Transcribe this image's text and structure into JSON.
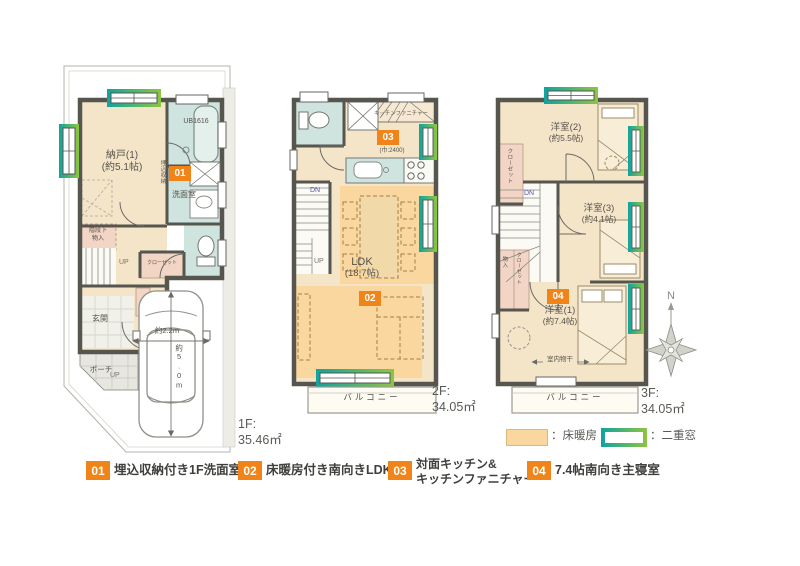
{
  "floor1": {
    "label": "1F:",
    "area": "35.46㎡",
    "badge": "01",
    "nando": "納戸(1)",
    "nando_size": "(約5.1帖)",
    "ub": "UB1616",
    "umekomi": "埋込収納",
    "senmen": "洗面室",
    "kaidanshita1": "階段下",
    "kaidanshita2": "物入",
    "closet": "クローゼット",
    "genkan": "玄関",
    "porch": "ポーチ",
    "up1": "UP",
    "up2": "UP",
    "car_w": "約2.2m",
    "car_d": "約5.0m"
  },
  "floor2": {
    "label": "2F:",
    "area": "34.05㎡",
    "badge_ldk": "02",
    "badge_kitchen": "03",
    "kitchen_furniture": "キッチンファニチャー",
    "kitchen_width": "(巾:2400)",
    "ldk": "LDK",
    "ldk_size": "(18.7帖)",
    "dn": "DN",
    "up": "UP",
    "balcony": "バルコニー"
  },
  "floor3": {
    "label": "3F:",
    "area": "34.05㎡",
    "badge": "04",
    "yoshitsu2": "洋室(2)",
    "yoshitsu2_size": "(約5.5帖)",
    "yoshitsu3": "洋室(3)",
    "yoshitsu3_size": "(約4.1帖)",
    "yoshitsu1": "洋室(1)",
    "yoshitsu1_size": "(約7.4帖)",
    "closet_upper": "クローゼット",
    "closet_lower": "クローゼット",
    "monoire": "物入",
    "dn": "DN",
    "drying": "室内物干",
    "balcony": "バルコニー"
  },
  "compass": {
    "north": "N"
  },
  "legend": {
    "heating": "：床暖房",
    "double_window": "：二重窓"
  },
  "notes": [
    {
      "num": "01",
      "line1": "埋込収納付き1F洗面室",
      "line2": ""
    },
    {
      "num": "02",
      "line1": "床暖房付き南向きLDK",
      "line2": ""
    },
    {
      "num": "03",
      "line1": "対面キッチン&",
      "line2": "キッチンファニチャー"
    },
    {
      "num": "04",
      "line1": "7.4帖南向き主寝室",
      "line2": ""
    }
  ],
  "colors": {
    "wall": "#56554e",
    "wood": "#f4e5c9",
    "wet": "#cfe3df",
    "storage": "#f2d5c4",
    "heating": "#f9d79e",
    "badge": "#f08418",
    "teal": "#14a29d",
    "green": "#8cc63f"
  }
}
